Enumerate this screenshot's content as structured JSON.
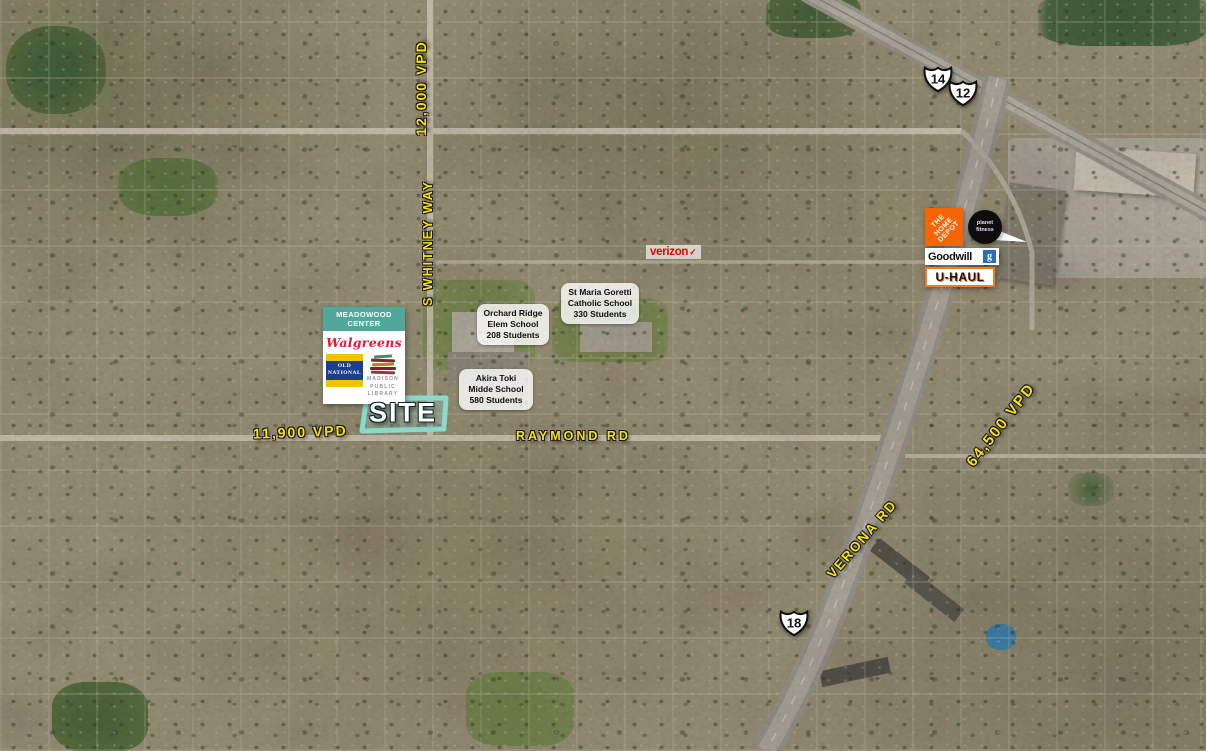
{
  "traffic": {
    "whitney": "12,000 VPD",
    "raymond": "11,900 VPD",
    "verona": "64,500 VPD"
  },
  "roads": {
    "whitney": "S WHITNEY WAY",
    "raymond": "RAYMOND RD",
    "verona": "VERONA RD"
  },
  "shields": {
    "route14": "14",
    "route12": "12",
    "route18": "18"
  },
  "site": {
    "label": "SITE"
  },
  "meadowood": {
    "title": "MEADOWOOD CENTER",
    "walgreens": "Walgreens",
    "old_national": {
      "line1": "OLD",
      "line2": "NATIONAL"
    },
    "library": {
      "line1": "MADISON",
      "line2": "PUBLIC",
      "line3": "LIBRARY"
    }
  },
  "retail_cluster": {
    "home_depot": {
      "line1": "THE",
      "line2": "HOME",
      "line3": "DEPOT"
    },
    "planet_fitness": {
      "line1": "planet",
      "line2": "fitness"
    },
    "goodwill": {
      "name": "Goodwill",
      "icon_letter": "g"
    },
    "uhaul": "U-HAUL"
  },
  "verizon": {
    "name": "verizon",
    "check": "✓"
  },
  "schools": [
    {
      "line1": "Orchard Ridge",
      "line2": "Elem School",
      "line3": "208 Students"
    },
    {
      "line1": "St Maria Goretti",
      "line2": "Catholic School",
      "line3": "330 Students"
    },
    {
      "line1": "Akira Toki",
      "line2": "Midde School",
      "line3": "580 Students"
    }
  ],
  "colors": {
    "label_yellow": "#f8e018",
    "teal_header": "#4fa89a",
    "site_outline": "#8bd9ca",
    "verizon_red": "#e60000",
    "home_depot_orange": "#f96302",
    "uhaul_orange": "#f47c20",
    "goodwill_blue": "#2a6ebb",
    "old_national_blue": "#1c3e8f",
    "old_national_gold": "#f2c200",
    "walgreens_red": "#e31837"
  }
}
